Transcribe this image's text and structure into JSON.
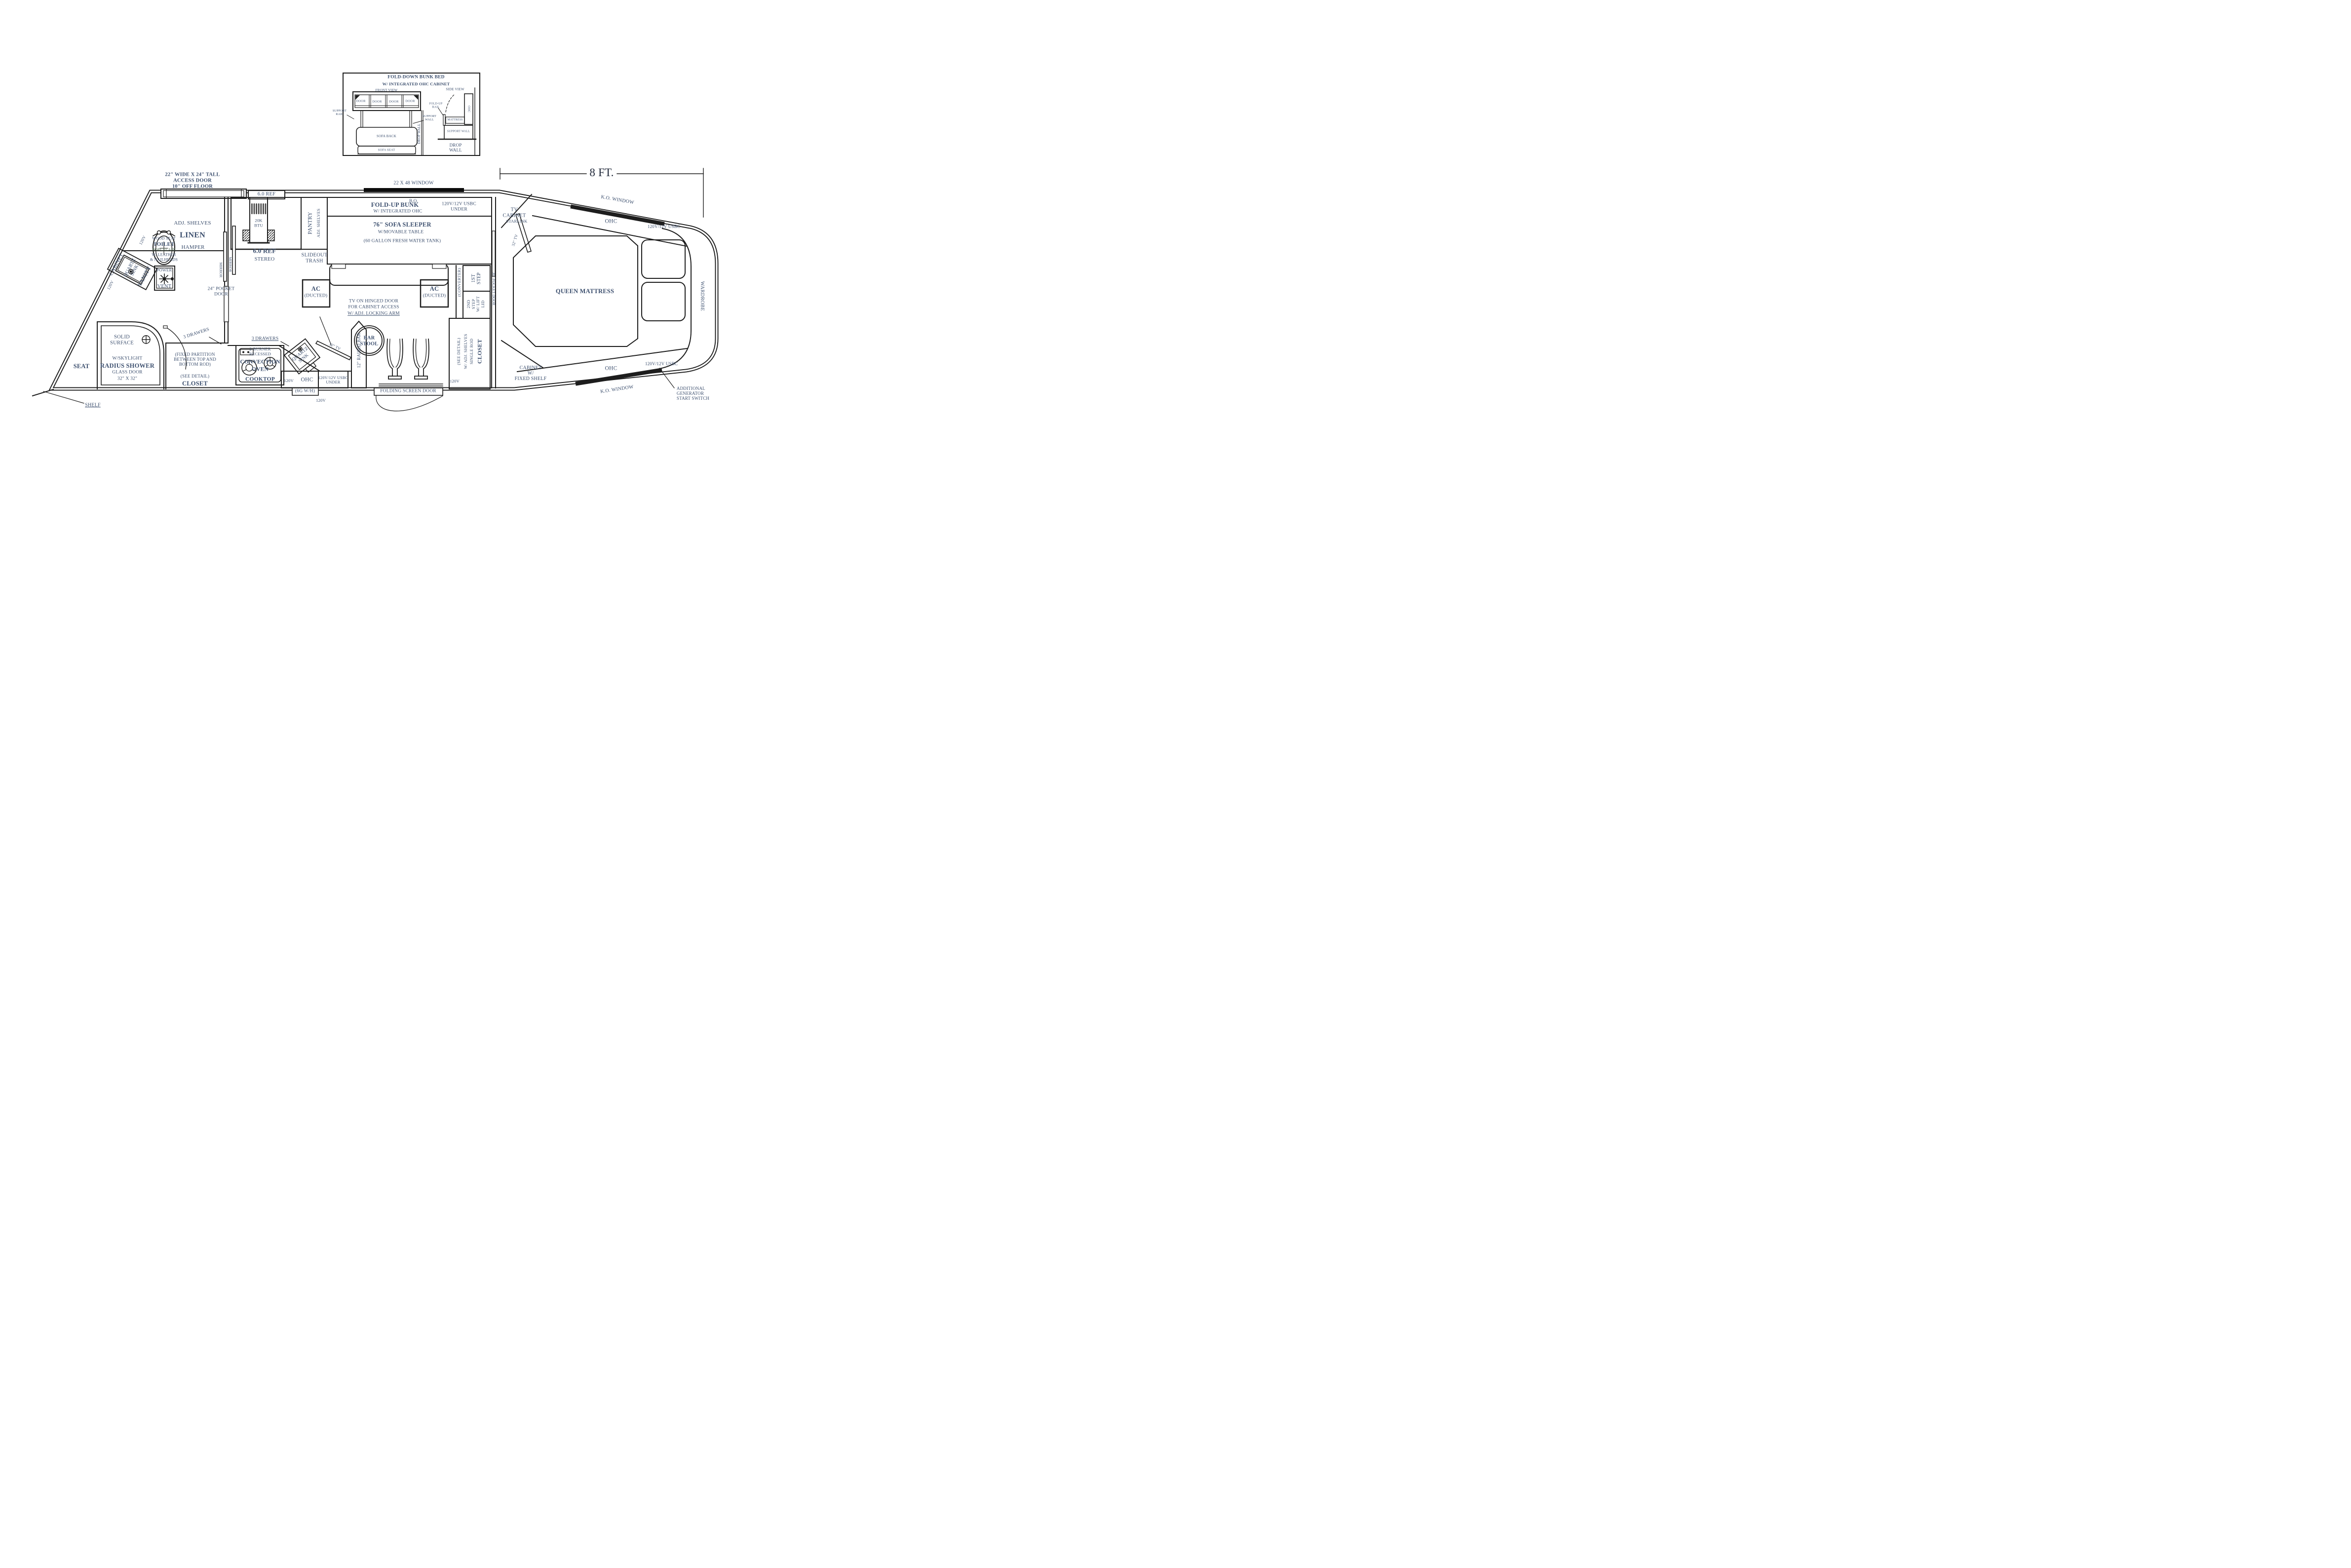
{
  "colors": {
    "ink": "#3c4f6e",
    "line": "#1d1d1d",
    "window_fill": "#0c0c0c",
    "porcelain": "#4e6b50"
  },
  "shared": {
    "v120": "120V",
    "ohc": "OHC",
    "usbc": "120V/12V USBC",
    "usbc_under": "120V/12V USBC\nUNDER",
    "tv32": "32\" TV",
    "mirror": "MIRROR",
    "door": "DOOR",
    "ref": "6.0 REF",
    "ko_window": "K.O. WINDOW",
    "drawers3": "3 DRAWERS",
    "see_detail": "(SEE DETAIL)",
    "ac": "AC",
    "ducted": "(DUCTED)",
    "quartz_sink": "QUARTZ\nSINK"
  },
  "dimension": {
    "eight_ft": "8 FT."
  },
  "inset": {
    "title1": "FOLD-DOWN BUNK BED",
    "title2": "W/ INTEGRATED OHC CABINET",
    "front_view": "FRONT VIEW",
    "side_view": "SIDE VIEW",
    "support_rail": "SUPPORT\nRAIL",
    "support_wall": "SUPPORT\nWALL",
    "sofa_back": "SOFA BACK",
    "sofa_seat": "SOFA SEAT",
    "drop_wall_plan": "DROP WALL",
    "fold_up_rail": "FOLD-UP\nRAIL",
    "mattress": "MATTRESS",
    "support_wall2": "SUPPORT WALL",
    "drop_wall2": "DROP\nWALL"
  },
  "top": {
    "access": "22\" WIDE X 24\" TALL\nACCESS DOOR\n10\" OFF FLOOR",
    "window2248": "22 X 48 WINDOW",
    "bo": "B.O."
  },
  "bath": {
    "adj_shelves": "ADJ. SHELVES",
    "linen": "LINEN",
    "hamper": "HAMPER",
    "cabinet": "CABINET",
    "vanity": "VANITY",
    "toilet1": "WOOD SEAT",
    "toilet2": "TOILET",
    "toilet3": "PORCELAIN",
    "toilet4": "W/ LEATHER",
    "toilet5": "& NAILHEADS",
    "power": "POWER",
    "vent": "VENT",
    "pocket24": "24\" POCKET\nDOOR"
  },
  "galley": {
    "btu": "20K\nBTU",
    "stereo": "STEREO",
    "pantry": "PANTRY",
    "pantry_shelves": "ADJ. SHELVES",
    "slideout": "SLIDEOUT\nTRASH"
  },
  "sofa": {
    "bunk1": "FOLD-UP BUNK",
    "bunk2": "W/  INTEGRATED OHC",
    "sleeper1": "76\" SOFA SLEEPER",
    "sleeper2": "W/MOVABLE TABLE",
    "sleeper3": "(60 GALLON FRESH WATER TANK)"
  },
  "note": {
    "l1": "TV ON HINGED DOOR",
    "l2": "FOR CABINET ACCESS",
    "l3": "W/ ADJ. LOCKING ARM"
  },
  "bedroom": {
    "tv_cabinet": "TV\nCABINET",
    "starlink": "STARLINK",
    "queen": "QUEEN MATTRESS",
    "wardrobe": "WARDROBE",
    "cabinet_fixed": "CABINET\nW/\nFIXED SHELF",
    "gen_switch": "ADDITIONAL\nGENERATOR\nSTART SWITCH",
    "pocket30": "30\" POCKET DOOR"
  },
  "steps": {
    "converter": "(CONVERTER)",
    "step1": "1ST\nSTEP",
    "step2": "2ND\nSTEP\nW/ LIFT\nLID",
    "closet1": "CLOSET",
    "closet2": "SINGLE ROD",
    "closet3": "W/ ADJ. SHELVES"
  },
  "kitchen": {
    "fixed_partition": "(FIXED PARTITION\nBETWEEN TOP AND\nBOTTOM ROD)",
    "closet": "CLOSET",
    "burner1": "2-BURNER",
    "burner2": "RECESSED",
    "conv1": "CONVECTION",
    "conv2": "OVEN",
    "conv3": "COOKTOP",
    "raised_bar": "12\" RAISED BAR",
    "bar": "BAR\nSTOOL",
    "folding": "FOLDING SCREEN DOOR",
    "wh": "(6G W/H)"
  },
  "shower": {
    "solid": "SOLID\nSURFACE",
    "l1": "W/SKYLIGHT",
    "l2": "RADIUS SHOWER",
    "l3": "GLASS DOOR",
    "l4": "32\" X 32\"",
    "seat": "SEAT",
    "shelf": "SHELF"
  }
}
